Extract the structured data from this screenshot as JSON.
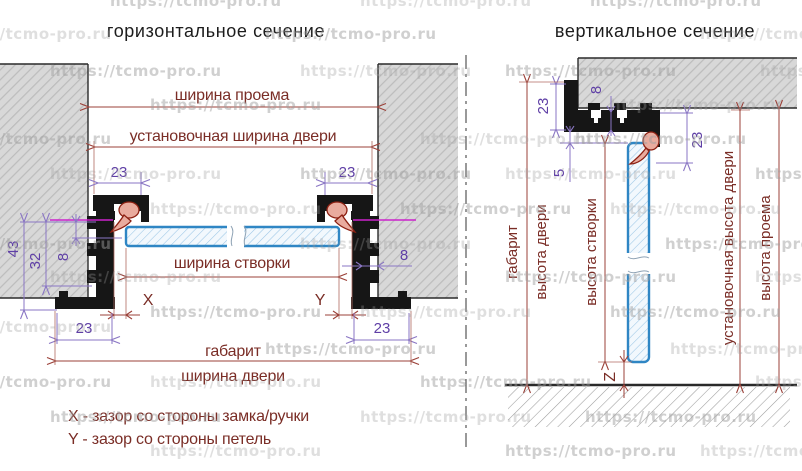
{
  "watermark": {
    "text": "https://tcmo-pro.ru"
  },
  "colors": {
    "dim_red": "#9b4038",
    "text_red": "#7a2d26",
    "dim_purple": "#8a76c4",
    "text_purple": "#5f3fa6",
    "magenta": "#cc22cc",
    "profile_black": "#161616",
    "sash_blue": "#2f86c4",
    "seal_pink": "#e9ab9e",
    "wall_gray": "#d8d8d8",
    "watermark_gray": "#9e9e9e"
  },
  "horizontal_section": {
    "title": "горизонтальное сечение",
    "labels": {
      "opening_width": "ширина проема",
      "install_width": "установочная ширина двери",
      "sash_width": "ширина створки",
      "overall": "габарит",
      "door_width": "ширина двери",
      "gap_lock": "X",
      "gap_hinge": "Y",
      "top_left_23": "23",
      "top_right_23": "23",
      "bottom_left_23": "23",
      "bottom_right_23": "23",
      "depth_43": "43",
      "depth_32": "32",
      "depth_8_left": "8",
      "depth_8_right": "8"
    },
    "legend": {
      "x_note": "X - зазор со стороны замка/ручки",
      "y_note": "Y - зазор со стороны петель"
    }
  },
  "vertical_section": {
    "title": "вертикальное сечение",
    "labels": {
      "overall": "габарит",
      "door_height": "высота двери",
      "sash_height": "высота створки",
      "install_height": "установочная высота двери",
      "opening_height": "высота проема",
      "top_23": "23",
      "wall_8": "8",
      "right_23": "23",
      "gap_5": "5",
      "floor_gap": "Z"
    }
  }
}
